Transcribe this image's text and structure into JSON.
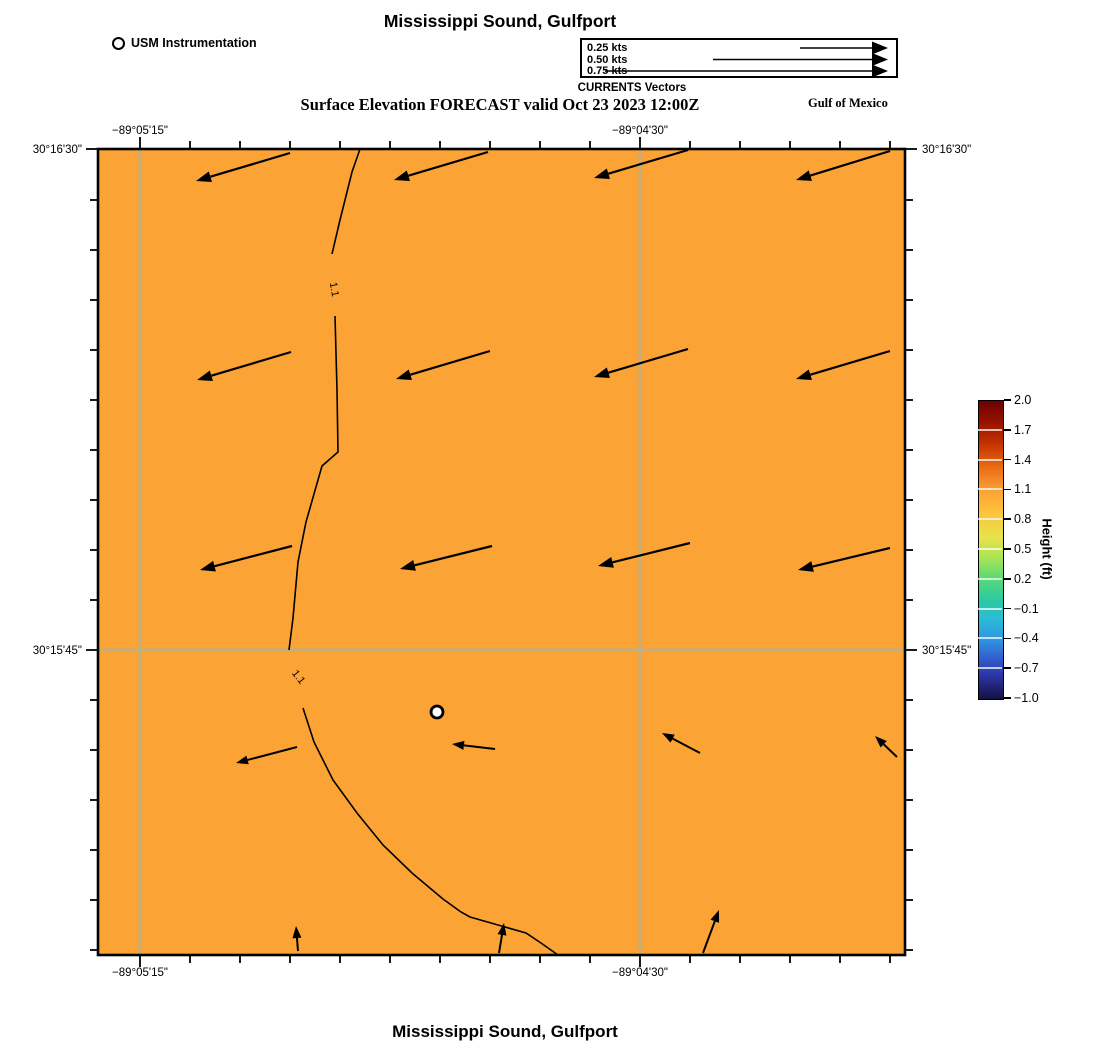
{
  "header": {
    "title": "Mississippi Sound, Gulfport",
    "subtitle": "Surface Elevation FORECAST valid Oct 23 2023 12:00Z",
    "region_label": "Gulf of Mexico",
    "instrumentation_label": "USM Instrumentation",
    "currents_legend": {
      "caption": "CURRENTS Vectors",
      "entries": [
        {
          "label": "0.25 kts",
          "tail_x": 218
        },
        {
          "label": "0.50 kts",
          "tail_x": 131
        },
        {
          "label": "0.75 kts",
          "tail_x": 23
        }
      ],
      "head_x": 306,
      "row_y": [
        8,
        19.5,
        31
      ]
    }
  },
  "footer": {
    "title": "Mississippi Sound, Gulfport"
  },
  "map": {
    "plot": {
      "left": 98,
      "top": 149,
      "right": 905,
      "bottom": 955
    },
    "bg_color": "#FBA335",
    "grid_color": "#C2AF80",
    "border_color": "#000000",
    "grid_vertical_x": [
      140,
      640
    ],
    "grid_horizontal_y": [
      650
    ],
    "x_ticks": [
      140,
      190,
      240,
      290,
      340,
      390,
      440,
      490,
      540,
      590,
      640,
      690,
      740,
      790,
      840,
      890
    ],
    "x_major": [
      140,
      640
    ],
    "y_ticks": [
      149,
      200,
      250,
      300,
      350,
      400,
      450,
      500,
      550,
      600,
      650,
      700,
      750,
      800,
      850,
      900,
      950
    ],
    "y_major": [
      149,
      650
    ],
    "x_labels": [
      {
        "pos": 140,
        "label": "−89°05'15\""
      },
      {
        "pos": 640,
        "label": "−89°04'30\""
      }
    ],
    "y_labels": [
      {
        "pos": 149,
        "label": "30°16'30\""
      },
      {
        "pos": 650,
        "label": "30°15'45\""
      }
    ]
  },
  "colorbar": {
    "label": "Height (ft)",
    "left": 978,
    "top": 400,
    "width": 24,
    "height": 298,
    "tick_labels": [
      "2.0",
      "1.7",
      "1.4",
      "1.1",
      "0.8",
      "0.5",
      "0.2",
      "−0.1",
      "−0.4",
      "−0.7",
      "−1.0"
    ],
    "stops": [
      {
        "p": 0,
        "c": "#700000"
      },
      {
        "p": 7,
        "c": "#961200"
      },
      {
        "p": 14,
        "c": "#c23000"
      },
      {
        "p": 22,
        "c": "#e96a12"
      },
      {
        "p": 30,
        "c": "#fba235"
      },
      {
        "p": 38,
        "c": "#fdc53e"
      },
      {
        "p": 46,
        "c": "#e8e34c"
      },
      {
        "p": 53,
        "c": "#a5e455"
      },
      {
        "p": 60,
        "c": "#55d878"
      },
      {
        "p": 67,
        "c": "#2cc9a4"
      },
      {
        "p": 73,
        "c": "#2bbcd6"
      },
      {
        "p": 80,
        "c": "#2f97e0"
      },
      {
        "p": 86,
        "c": "#3260d0"
      },
      {
        "p": 93,
        "c": "#2b2f9e"
      },
      {
        "p": 100,
        "c": "#151240"
      }
    ]
  },
  "chart_data": {
    "type": "vector_field_map",
    "title": "Mississippi Sound, Gulfport",
    "subtitle": "Surface Elevation FORECAST valid Oct 23 2023 12:00Z",
    "region": "Gulf of Mexico",
    "x_axis": {
      "label_ticks": [
        "−89°05'15\"",
        "−89°04'30\""
      ]
    },
    "y_axis": {
      "label_ticks": [
        "30°16'30\"",
        "30°15'45\""
      ]
    },
    "surface_elevation_contour_ft": 1.1,
    "colorbar": {
      "label": "Height (ft)",
      "min": -1.0,
      "max": 2.0,
      "ticks": [
        2.0,
        1.7,
        1.4,
        1.1,
        0.8,
        0.5,
        0.2,
        -0.1,
        -0.4,
        -0.7,
        -1.0
      ]
    },
    "station": {
      "name": "USM Instrumentation",
      "x": 437,
      "y": 712,
      "r": 6
    },
    "contour": {
      "level_label": "1.1",
      "segments": [
        [
          [
            360,
            149
          ],
          [
            352,
            172
          ],
          [
            340,
            220
          ],
          [
            332,
            254
          ]
        ],
        [
          [
            335,
            316
          ],
          [
            337,
            390
          ],
          [
            338,
            452
          ],
          [
            322,
            466
          ],
          [
            306,
            522
          ],
          [
            298,
            562
          ],
          [
            293,
            618
          ],
          [
            289,
            650
          ]
        ],
        [
          [
            303,
            708
          ],
          [
            314,
            742
          ],
          [
            333,
            780
          ],
          [
            357,
            813
          ],
          [
            383,
            845
          ],
          [
            412,
            873
          ],
          [
            443,
            899
          ],
          [
            461,
            912
          ],
          [
            470,
            917
          ],
          [
            498,
            925
          ],
          [
            526,
            933
          ],
          [
            541,
            943
          ],
          [
            558,
            955
          ]
        ]
      ],
      "labels": [
        {
          "x": 331,
          "y": 290,
          "rot": 80
        },
        {
          "x": 296,
          "y": 679,
          "rot": 52
        }
      ]
    },
    "vectors_big": [
      [
        290,
        153,
        196,
        181
      ],
      [
        488,
        152,
        394,
        180
      ],
      [
        688,
        150,
        594,
        178
      ],
      [
        890,
        151,
        796,
        180
      ],
      [
        291,
        352,
        197,
        380
      ],
      [
        490,
        351,
        396,
        379
      ],
      [
        688,
        349,
        594,
        377
      ],
      [
        890,
        351,
        796,
        379
      ],
      [
        292,
        546,
        200,
        570
      ],
      [
        492,
        546,
        400,
        569
      ],
      [
        690,
        543,
        598,
        566
      ],
      [
        890,
        548,
        798,
        570
      ]
    ],
    "vectors_small": [
      [
        297,
        747,
        236,
        763
      ],
      [
        495,
        749,
        452,
        744
      ],
      [
        700,
        753,
        662,
        733
      ],
      [
        897,
        757,
        875,
        736
      ],
      [
        298,
        951,
        296,
        926
      ],
      [
        499,
        953,
        504,
        923
      ],
      [
        703,
        953,
        719,
        910
      ]
    ]
  }
}
